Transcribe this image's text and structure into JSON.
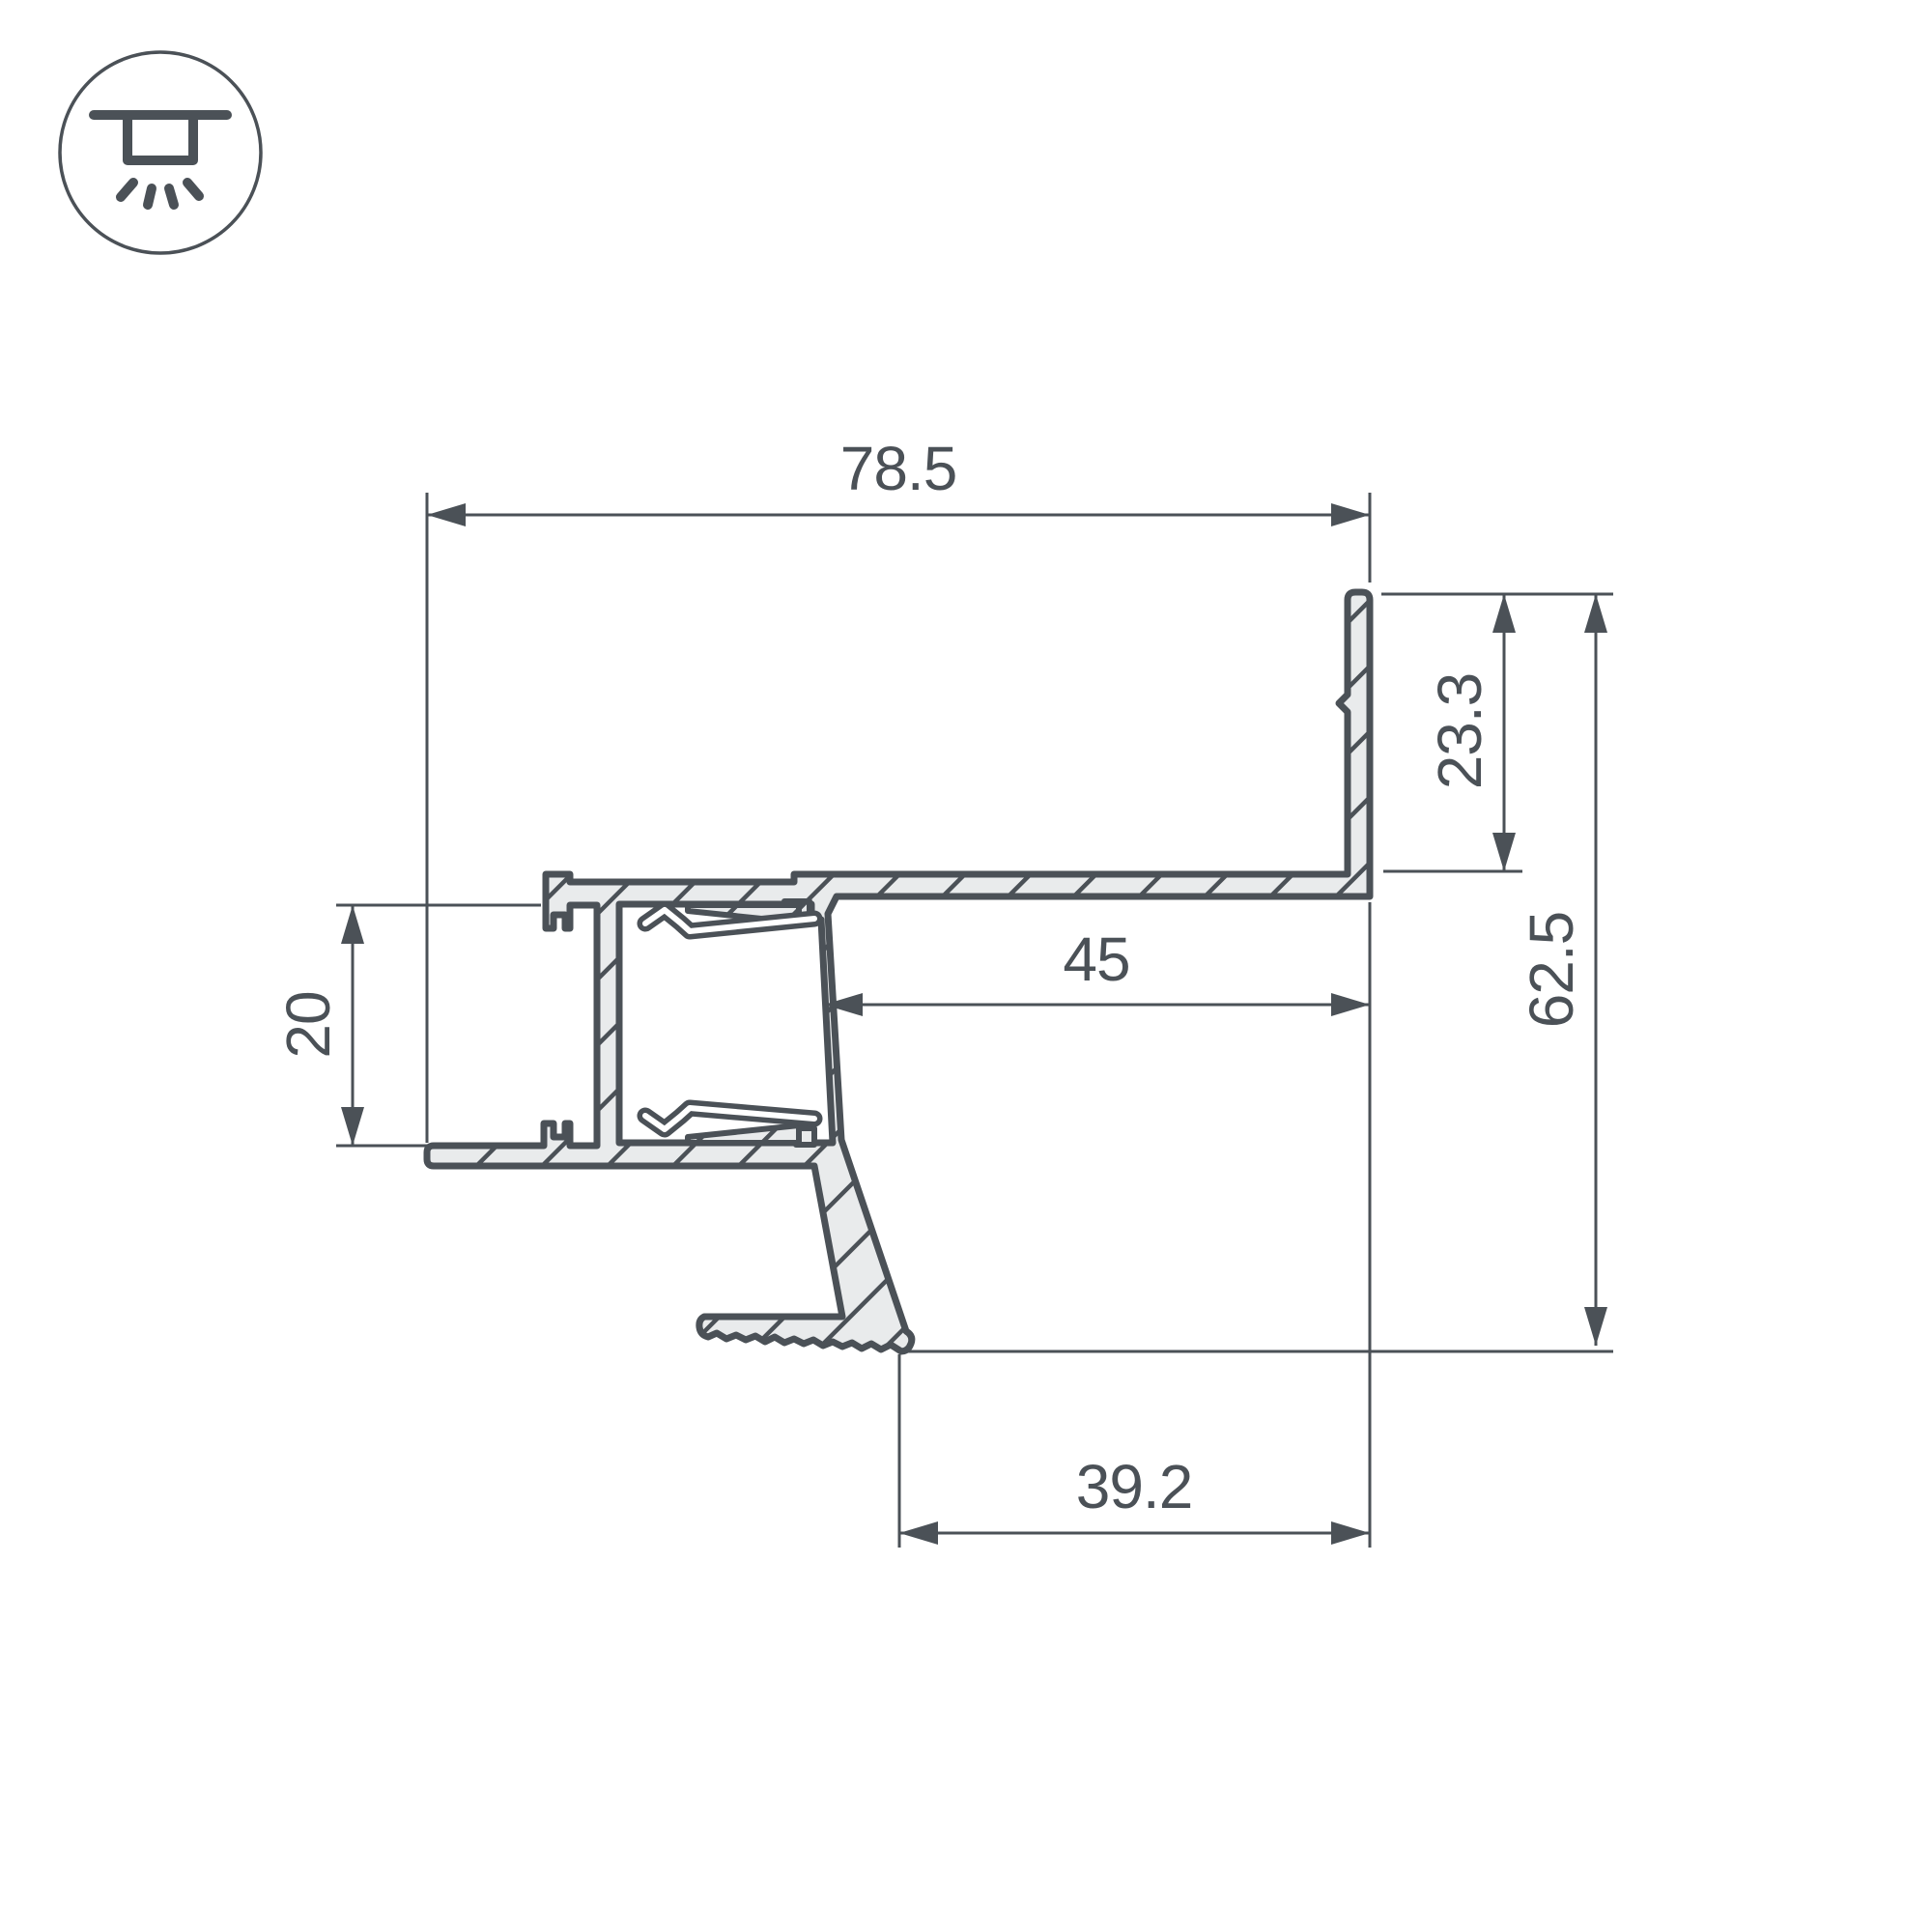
{
  "page": {
    "background_color": "#ffffff",
    "kind": "technical-drawing"
  },
  "legend_icon": {
    "name": "recessed-ceiling-downlight-icon"
  },
  "drawing": {
    "stroke_color": "#4b5157",
    "aluminum_fill_color": "#e9ebec",
    "dimensions": {
      "overall_width": "78.5",
      "flange_height": "23.3",
      "overall_height": "62.5",
      "channel_inset_width": "45",
      "mounting_opening_height": "20",
      "foot_offset_width": "39.2"
    }
  }
}
